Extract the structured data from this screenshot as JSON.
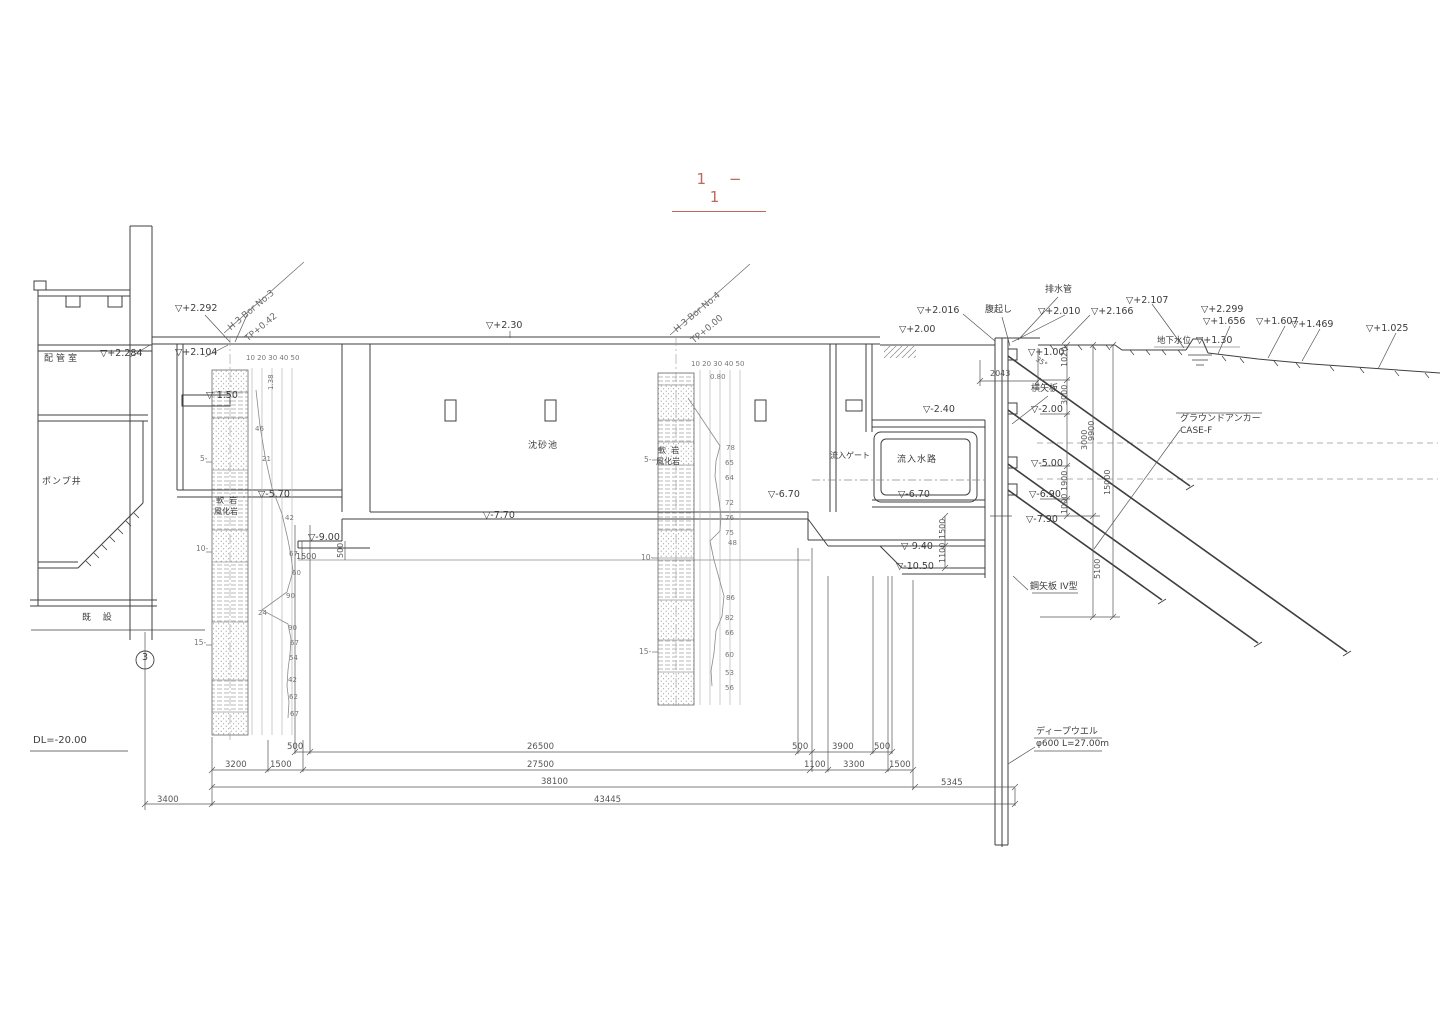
{
  "title": {
    "text": "1 − 1"
  },
  "colors": {
    "line": "#3f3f3f",
    "muted": "#8a8a8a",
    "accent": "#c0685c",
    "dim_text": "#555555"
  },
  "annotations": [
    {
      "n": "elev-marker",
      "t": "▽+2.292",
      "x": 175,
      "y": 304
    },
    {
      "n": "elev-marker",
      "t": "▽+2.284",
      "x": 100,
      "y": 349
    },
    {
      "n": "elev-marker",
      "t": "▽+2.104",
      "x": 175,
      "y": 348
    },
    {
      "n": "elev-marker",
      "t": "▽+2.30",
      "x": 486,
      "y": 321
    },
    {
      "n": "elev-marker",
      "t": "▽-1.50",
      "x": 206,
      "y": 391
    },
    {
      "n": "elev-marker",
      "t": "▽+2.00",
      "x": 899,
      "y": 325
    },
    {
      "n": "elev-marker",
      "t": "▽+2.016",
      "x": 917,
      "y": 306
    },
    {
      "n": "elev-marker",
      "t": "▽+2.010",
      "x": 1038,
      "y": 307
    },
    {
      "n": "elev-marker",
      "t": "▽+2.166",
      "x": 1091,
      "y": 307
    },
    {
      "n": "elev-marker",
      "t": "▽+2.107",
      "x": 1126,
      "y": 296
    },
    {
      "n": "elev-marker",
      "t": "▽+2.299",
      "x": 1201,
      "y": 305
    },
    {
      "n": "elev-marker",
      "t": "▽+1.656",
      "x": 1203,
      "y": 317
    },
    {
      "n": "groundwater-label",
      "t": "地下水位",
      "x": 1157,
      "y": 337,
      "s": 8.5
    },
    {
      "n": "elev-marker",
      "t": "▽+1.30",
      "x": 1196,
      "y": 336
    },
    {
      "n": "elev-marker",
      "t": "▽+1.607",
      "x": 1256,
      "y": 317
    },
    {
      "n": "elev-marker",
      "t": "▽+1.469",
      "x": 1291,
      "y": 320
    },
    {
      "n": "elev-marker",
      "t": "▽+1.025",
      "x": 1366,
      "y": 324
    },
    {
      "n": "elev-marker",
      "t": "▽+1.00",
      "x": 1028,
      "y": 348
    },
    {
      "n": "elev-marker",
      "t": "▽-2.40",
      "x": 923,
      "y": 405
    },
    {
      "n": "elev-marker",
      "t": "▽-2.00",
      "x": 1031,
      "y": 405
    },
    {
      "n": "elev-marker",
      "t": "▽-5.00",
      "x": 1031,
      "y": 459
    },
    {
      "n": "elev-marker",
      "t": "▽-5.70",
      "x": 258,
      "y": 490
    },
    {
      "n": "elev-marker",
      "t": "▽-6.70",
      "x": 768,
      "y": 490
    },
    {
      "n": "elev-marker",
      "t": "▽-6.70",
      "x": 898,
      "y": 490
    },
    {
      "n": "elev-marker",
      "t": "▽-6.90",
      "x": 1029,
      "y": 490
    },
    {
      "n": "elev-marker",
      "t": "▽-7.70",
      "x": 483,
      "y": 511
    },
    {
      "n": "elev-marker",
      "t": "▽-7.90",
      "x": 1026,
      "y": 515
    },
    {
      "n": "elev-marker",
      "t": "▽-9.00",
      "x": 308,
      "y": 533
    },
    {
      "n": "elev-marker",
      "t": "▽-9.40",
      "x": 901,
      "y": 542
    },
    {
      "n": "elev-marker",
      "t": "▽-10.50",
      "x": 896,
      "y": 562
    },
    {
      "n": "datum-label",
      "t": "DL=-20.00",
      "x": 33,
      "y": 736,
      "s": 10
    },
    {
      "n": "room-label-piping",
      "t": "配管室",
      "x": 44,
      "y": 355,
      "s": 9,
      "ls": 3
    },
    {
      "n": "room-label-pump-well",
      "t": "ポンプ井",
      "x": 42,
      "y": 478,
      "s": 9,
      "ls": 1
    },
    {
      "n": "existing-label",
      "t": "既  設",
      "x": 82,
      "y": 614,
      "s": 9,
      "ls": 2
    },
    {
      "n": "basin-label",
      "t": "沈砂池",
      "x": 528,
      "y": 442,
      "s": 9,
      "ls": 1
    },
    {
      "n": "soil-label",
      "t": "軟  岩",
      "x": 216,
      "y": 497,
      "s": 8
    },
    {
      "n": "soil-label",
      "t": "風化岩",
      "x": 214,
      "y": 508,
      "s": 8
    },
    {
      "n": "soil-label",
      "t": "軟  岩",
      "x": 658,
      "y": 447,
      "s": 8
    },
    {
      "n": "soil-label",
      "t": "風化岩",
      "x": 656,
      "y": 458,
      "s": 8
    },
    {
      "n": "gate-label",
      "t": "流入ゲート",
      "x": 830,
      "y": 452,
      "s": 8
    },
    {
      "n": "channel-label",
      "t": "流入水路",
      "x": 897,
      "y": 456,
      "s": 9,
      "ls": 1
    },
    {
      "n": "waler-label",
      "t": "腹起し",
      "x": 985,
      "y": 306,
      "s": 9
    },
    {
      "n": "drainpipe-label",
      "t": "排水管",
      "x": 1045,
      "y": 286,
      "s": 9
    },
    {
      "n": "lagging-label",
      "t": "横矢板",
      "x": 1031,
      "y": 385,
      "s": 9
    },
    {
      "n": "anchor-label",
      "t": "グラウンドアンカー",
      "x": 1180,
      "y": 415,
      "s": 9
    },
    {
      "n": "anchor-case-label",
      "t": "CASE-F",
      "x": 1180,
      "y": 427,
      "s": 9
    },
    {
      "n": "sheetpile-label",
      "t": "鋼矢板 IV型",
      "x": 1030,
      "y": 583,
      "s": 9
    },
    {
      "n": "deepwell-label",
      "t": "ディープウエル",
      "x": 1036,
      "y": 728,
      "s": 9
    },
    {
      "n": "deepwell-spec",
      "t": "φ600 L=27.00m",
      "x": 1036,
      "y": 740,
      "s": 9
    },
    {
      "n": "grid-number",
      "t": "3",
      "x": 142,
      "y": 653,
      "s": 9.5
    },
    {
      "n": "boring-name",
      "t": "H 3 Bor No.3",
      "x": 227,
      "y": 326,
      "r": -40,
      "s": 9,
      "c": "#6a6a6a"
    },
    {
      "n": "boring-tp",
      "t": "TP+0.42",
      "x": 244,
      "y": 337,
      "r": -40,
      "s": 9,
      "c": "#6a6a6a"
    },
    {
      "n": "boring-name",
      "t": "H 3 Bor No.4",
      "x": 673,
      "y": 328,
      "r": -40,
      "s": 9,
      "c": "#6a6a6a"
    },
    {
      "n": "boring-tp",
      "t": "TP+0.00",
      "x": 690,
      "y": 339,
      "r": -40,
      "s": 9,
      "c": "#6a6a6a"
    },
    {
      "n": "boring-scale",
      "t": "10 20 30 40 50",
      "x": 246,
      "y": 355,
      "s": 7,
      "c": "#777777"
    },
    {
      "n": "boring-scale",
      "t": "10 20 30 40 50",
      "x": 691,
      "y": 361,
      "s": 7,
      "c": "#777777"
    },
    {
      "n": "boring-depth-value",
      "t": "1.38",
      "x": 268,
      "y": 390,
      "r": -90,
      "s": 7,
      "c": "#777777"
    },
    {
      "n": "boring-depth-value",
      "t": "0.80",
      "x": 710,
      "y": 374,
      "s": 7,
      "c": "#777777"
    },
    {
      "n": "depth-mark",
      "t": "5-",
      "x": 200,
      "y": 455,
      "s": 7.5,
      "c": "#777777"
    },
    {
      "n": "depth-mark",
      "t": "10-",
      "x": 196,
      "y": 545,
      "s": 7.5,
      "c": "#777777"
    },
    {
      "n": "depth-mark",
      "t": "15-",
      "x": 194,
      "y": 639,
      "s": 7.5,
      "c": "#777777"
    },
    {
      "n": "depth-mark",
      "t": "5-",
      "x": 644,
      "y": 456,
      "s": 7.5,
      "c": "#777777"
    },
    {
      "n": "depth-mark",
      "t": "10-",
      "x": 641,
      "y": 554,
      "s": 7.5,
      "c": "#777777"
    },
    {
      "n": "depth-mark",
      "t": "15-",
      "x": 639,
      "y": 648,
      "s": 7.5,
      "c": "#777777"
    },
    {
      "n": "n-value",
      "t": "46",
      "x": 255,
      "y": 426,
      "s": 7,
      "c": "#777777"
    },
    {
      "n": "n-value",
      "t": "21",
      "x": 262,
      "y": 456,
      "s": 7,
      "c": "#777777"
    },
    {
      "n": "n-value",
      "t": "42",
      "x": 285,
      "y": 515,
      "s": 7,
      "c": "#777777"
    },
    {
      "n": "n-value",
      "t": "67",
      "x": 289,
      "y": 551,
      "s": 7,
      "c": "#777777"
    },
    {
      "n": "n-value",
      "t": "60",
      "x": 292,
      "y": 570,
      "s": 7,
      "c": "#777777"
    },
    {
      "n": "n-value",
      "t": "90",
      "x": 286,
      "y": 593,
      "s": 7,
      "c": "#777777"
    },
    {
      "n": "n-value",
      "t": "24",
      "x": 258,
      "y": 610,
      "s": 7,
      "c": "#777777"
    },
    {
      "n": "n-value",
      "t": "90",
      "x": 288,
      "y": 625,
      "s": 7,
      "c": "#777777"
    },
    {
      "n": "n-value",
      "t": "67",
      "x": 290,
      "y": 640,
      "s": 7,
      "c": "#777777"
    },
    {
      "n": "n-value",
      "t": "54",
      "x": 289,
      "y": 655,
      "s": 7,
      "c": "#777777"
    },
    {
      "n": "n-value",
      "t": "42",
      "x": 288,
      "y": 677,
      "s": 7,
      "c": "#777777"
    },
    {
      "n": "n-value",
      "t": "62",
      "x": 289,
      "y": 694,
      "s": 7,
      "c": "#777777"
    },
    {
      "n": "n-value",
      "t": "67",
      "x": 290,
      "y": 711,
      "s": 7,
      "c": "#777777"
    },
    {
      "n": "n-value",
      "t": "78",
      "x": 726,
      "y": 445,
      "s": 7,
      "c": "#777777"
    },
    {
      "n": "n-value",
      "t": "65",
      "x": 725,
      "y": 460,
      "s": 7,
      "c": "#777777"
    },
    {
      "n": "n-value",
      "t": "64",
      "x": 725,
      "y": 475,
      "s": 7,
      "c": "#777777"
    },
    {
      "n": "n-value",
      "t": "72",
      "x": 725,
      "y": 500,
      "s": 7,
      "c": "#777777"
    },
    {
      "n": "n-value",
      "t": "76",
      "x": 725,
      "y": 515,
      "s": 7,
      "c": "#777777"
    },
    {
      "n": "n-value",
      "t": "75",
      "x": 725,
      "y": 530,
      "s": 7,
      "c": "#777777"
    },
    {
      "n": "n-value",
      "t": "48",
      "x": 728,
      "y": 540,
      "s": 7,
      "c": "#777777"
    },
    {
      "n": "n-value",
      "t": "86",
      "x": 726,
      "y": 595,
      "s": 7,
      "c": "#777777"
    },
    {
      "n": "n-value",
      "t": "82",
      "x": 725,
      "y": 615,
      "s": 7,
      "c": "#777777"
    },
    {
      "n": "n-value",
      "t": "66",
      "x": 725,
      "y": 630,
      "s": 7,
      "c": "#777777"
    },
    {
      "n": "n-value",
      "t": "60",
      "x": 725,
      "y": 652,
      "s": 7,
      "c": "#777777"
    },
    {
      "n": "n-value",
      "t": "53",
      "x": 725,
      "y": 670,
      "s": 7,
      "c": "#777777"
    },
    {
      "n": "n-value",
      "t": "56",
      "x": 725,
      "y": 685,
      "s": 7,
      "c": "#777777"
    },
    {
      "n": "dim",
      "t": "500",
      "x": 287,
      "y": 743,
      "s": 8.5,
      "c": "#555555"
    },
    {
      "n": "dim",
      "t": "26500",
      "x": 527,
      "y": 743,
      "s": 8.5,
      "c": "#555555"
    },
    {
      "n": "dim",
      "t": "500",
      "x": 792,
      "y": 743,
      "s": 8.5,
      "c": "#555555"
    },
    {
      "n": "dim",
      "t": "3900",
      "x": 832,
      "y": 743,
      "s": 8.5,
      "c": "#555555"
    },
    {
      "n": "dim",
      "t": "500",
      "x": 874,
      "y": 743,
      "s": 8.5,
      "c": "#555555"
    },
    {
      "n": "dim",
      "t": "3200",
      "x": 225,
      "y": 761,
      "s": 8.5,
      "c": "#555555"
    },
    {
      "n": "dim",
      "t": "1500",
      "x": 270,
      "y": 761,
      "s": 8.5,
      "c": "#555555"
    },
    {
      "n": "dim",
      "t": "27500",
      "x": 527,
      "y": 761,
      "s": 8.5,
      "c": "#555555"
    },
    {
      "n": "dim",
      "t": "1100",
      "x": 804,
      "y": 761,
      "s": 8.5,
      "c": "#555555"
    },
    {
      "n": "dim",
      "t": "3300",
      "x": 843,
      "y": 761,
      "s": 8.5,
      "c": "#555555"
    },
    {
      "n": "dim",
      "t": "1500",
      "x": 889,
      "y": 761,
      "s": 8.5,
      "c": "#555555"
    },
    {
      "n": "dim",
      "t": "38100",
      "x": 541,
      "y": 778,
      "s": 8.5,
      "c": "#555555"
    },
    {
      "n": "dim",
      "t": "5345",
      "x": 941,
      "y": 779,
      "s": 8.5,
      "c": "#555555"
    },
    {
      "n": "dim",
      "t": "3400",
      "x": 157,
      "y": 796,
      "s": 8.5,
      "c": "#555555"
    },
    {
      "n": "dim",
      "t": "43445",
      "x": 594,
      "y": 796,
      "s": 8.5,
      "c": "#555555"
    },
    {
      "n": "dim",
      "t": "1500",
      "x": 296,
      "y": 553,
      "s": 8,
      "c": "#555555"
    },
    {
      "n": "dim",
      "t": "500",
      "x": 337,
      "y": 558,
      "r": -90,
      "s": 8,
      "c": "#555555"
    },
    {
      "n": "dim",
      "t": "2043",
      "x": 990,
      "y": 370,
      "s": 8,
      "c": "#555555"
    },
    {
      "n": "dim",
      "t": "1020",
      "x": 1061,
      "y": 367,
      "r": -90,
      "s": 8,
      "c": "#555555"
    },
    {
      "n": "dim",
      "t": "3000",
      "x": 1061,
      "y": 405,
      "r": -90,
      "s": 8,
      "c": "#555555"
    },
    {
      "n": "dim",
      "t": "3000",
      "x": 1081,
      "y": 450,
      "r": -90,
      "s": 8,
      "c": "#555555"
    },
    {
      "n": "dim",
      "t": "1900",
      "x": 1061,
      "y": 491,
      "r": -90,
      "s": 8,
      "c": "#555555"
    },
    {
      "n": "dim",
      "t": "1000",
      "x": 1061,
      "y": 514,
      "r": -90,
      "s": 8,
      "c": "#555555"
    },
    {
      "n": "dim",
      "t": "9900",
      "x": 1088,
      "y": 441,
      "r": -90,
      "s": 8,
      "c": "#555555"
    },
    {
      "n": "dim",
      "t": "15000",
      "x": 1104,
      "y": 495,
      "r": -90,
      "s": 8,
      "c": "#555555"
    },
    {
      "n": "dim",
      "t": "5100",
      "x": 1094,
      "y": 579,
      "r": -90,
      "s": 8,
      "c": "#555555"
    },
    {
      "n": "dim",
      "t": "1500",
      "x": 939,
      "y": 539,
      "r": -90,
      "s": 8,
      "c": "#555555"
    },
    {
      "n": "dim",
      "t": "1100",
      "x": 939,
      "y": 563,
      "r": -90,
      "s": 8,
      "c": "#555555"
    },
    {
      "n": "anchor-angle",
      "t": "35°",
      "x": 1038,
      "y": 356,
      "r": 35,
      "s": 7,
      "c": "#555555"
    }
  ]
}
